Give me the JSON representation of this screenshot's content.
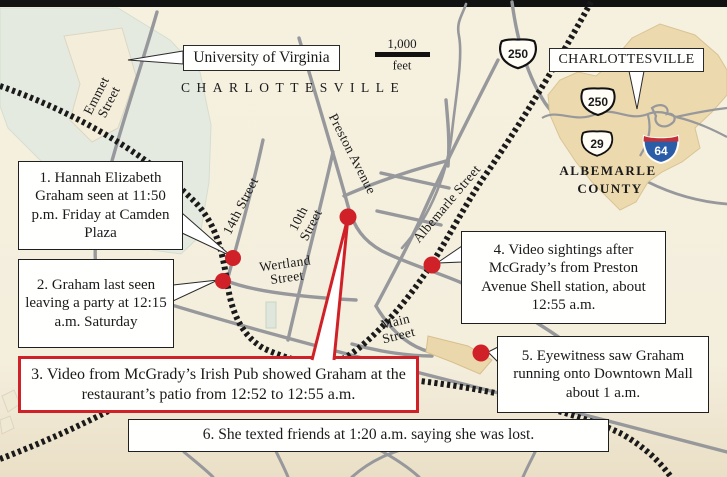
{
  "graphic": {
    "city_spread_label": "CHARLOTTESVILLE",
    "university_label": "University of Virginia"
  },
  "scale_bar": {
    "distance": "1,000",
    "unit": "feet"
  },
  "streets": {
    "emmet": "Emmet Street",
    "preston": "Preston Avenue",
    "fourteenth": "14th Street",
    "tenth": "10th Street",
    "wertland": "Wertland Street",
    "albemarle_st": "Albemarle Street",
    "main": "Main Street"
  },
  "shields": {
    "main_us250": "250",
    "inset_us250": "250",
    "inset_us29": "29",
    "inset_i64": "64"
  },
  "inset": {
    "city_label": "CHARLOTTESVILLE",
    "county_line1": "ALBEMARLE",
    "county_line2": "COUNTY"
  },
  "callouts": [
    {
      "id": "1",
      "text": "1. Hannah Elizabeth Graham seen at 11:50 p.m. Friday at Camden Plaza"
    },
    {
      "id": "2",
      "text": "2. Graham last seen leaving a party at 12:15 a.m. Saturday"
    },
    {
      "id": "3",
      "text": "3. Video from McGrady’s Irish Pub showed Graham at the restaurant’s patio from 12:52 to 12:55 a.m."
    },
    {
      "id": "4",
      "text": "4. Video sightings after McGrady’s from Preston Avenue Shell station, about 12:55 a.m."
    },
    {
      "id": "5",
      "text": "5. Eyewitness saw Graham running onto Downtown Mall about 1 a.m."
    },
    {
      "id": "6",
      "text": "6. She texted friends at 1:20 a.m. saying she was lost."
    }
  ],
  "colors": {
    "background": "#f4eedd",
    "road_gray": "#97989b",
    "rail_black": "#1a1a1a",
    "accent_red": "#cf2127",
    "campus_green": "#e4eae0",
    "city_tan": "#ecd9ae"
  }
}
